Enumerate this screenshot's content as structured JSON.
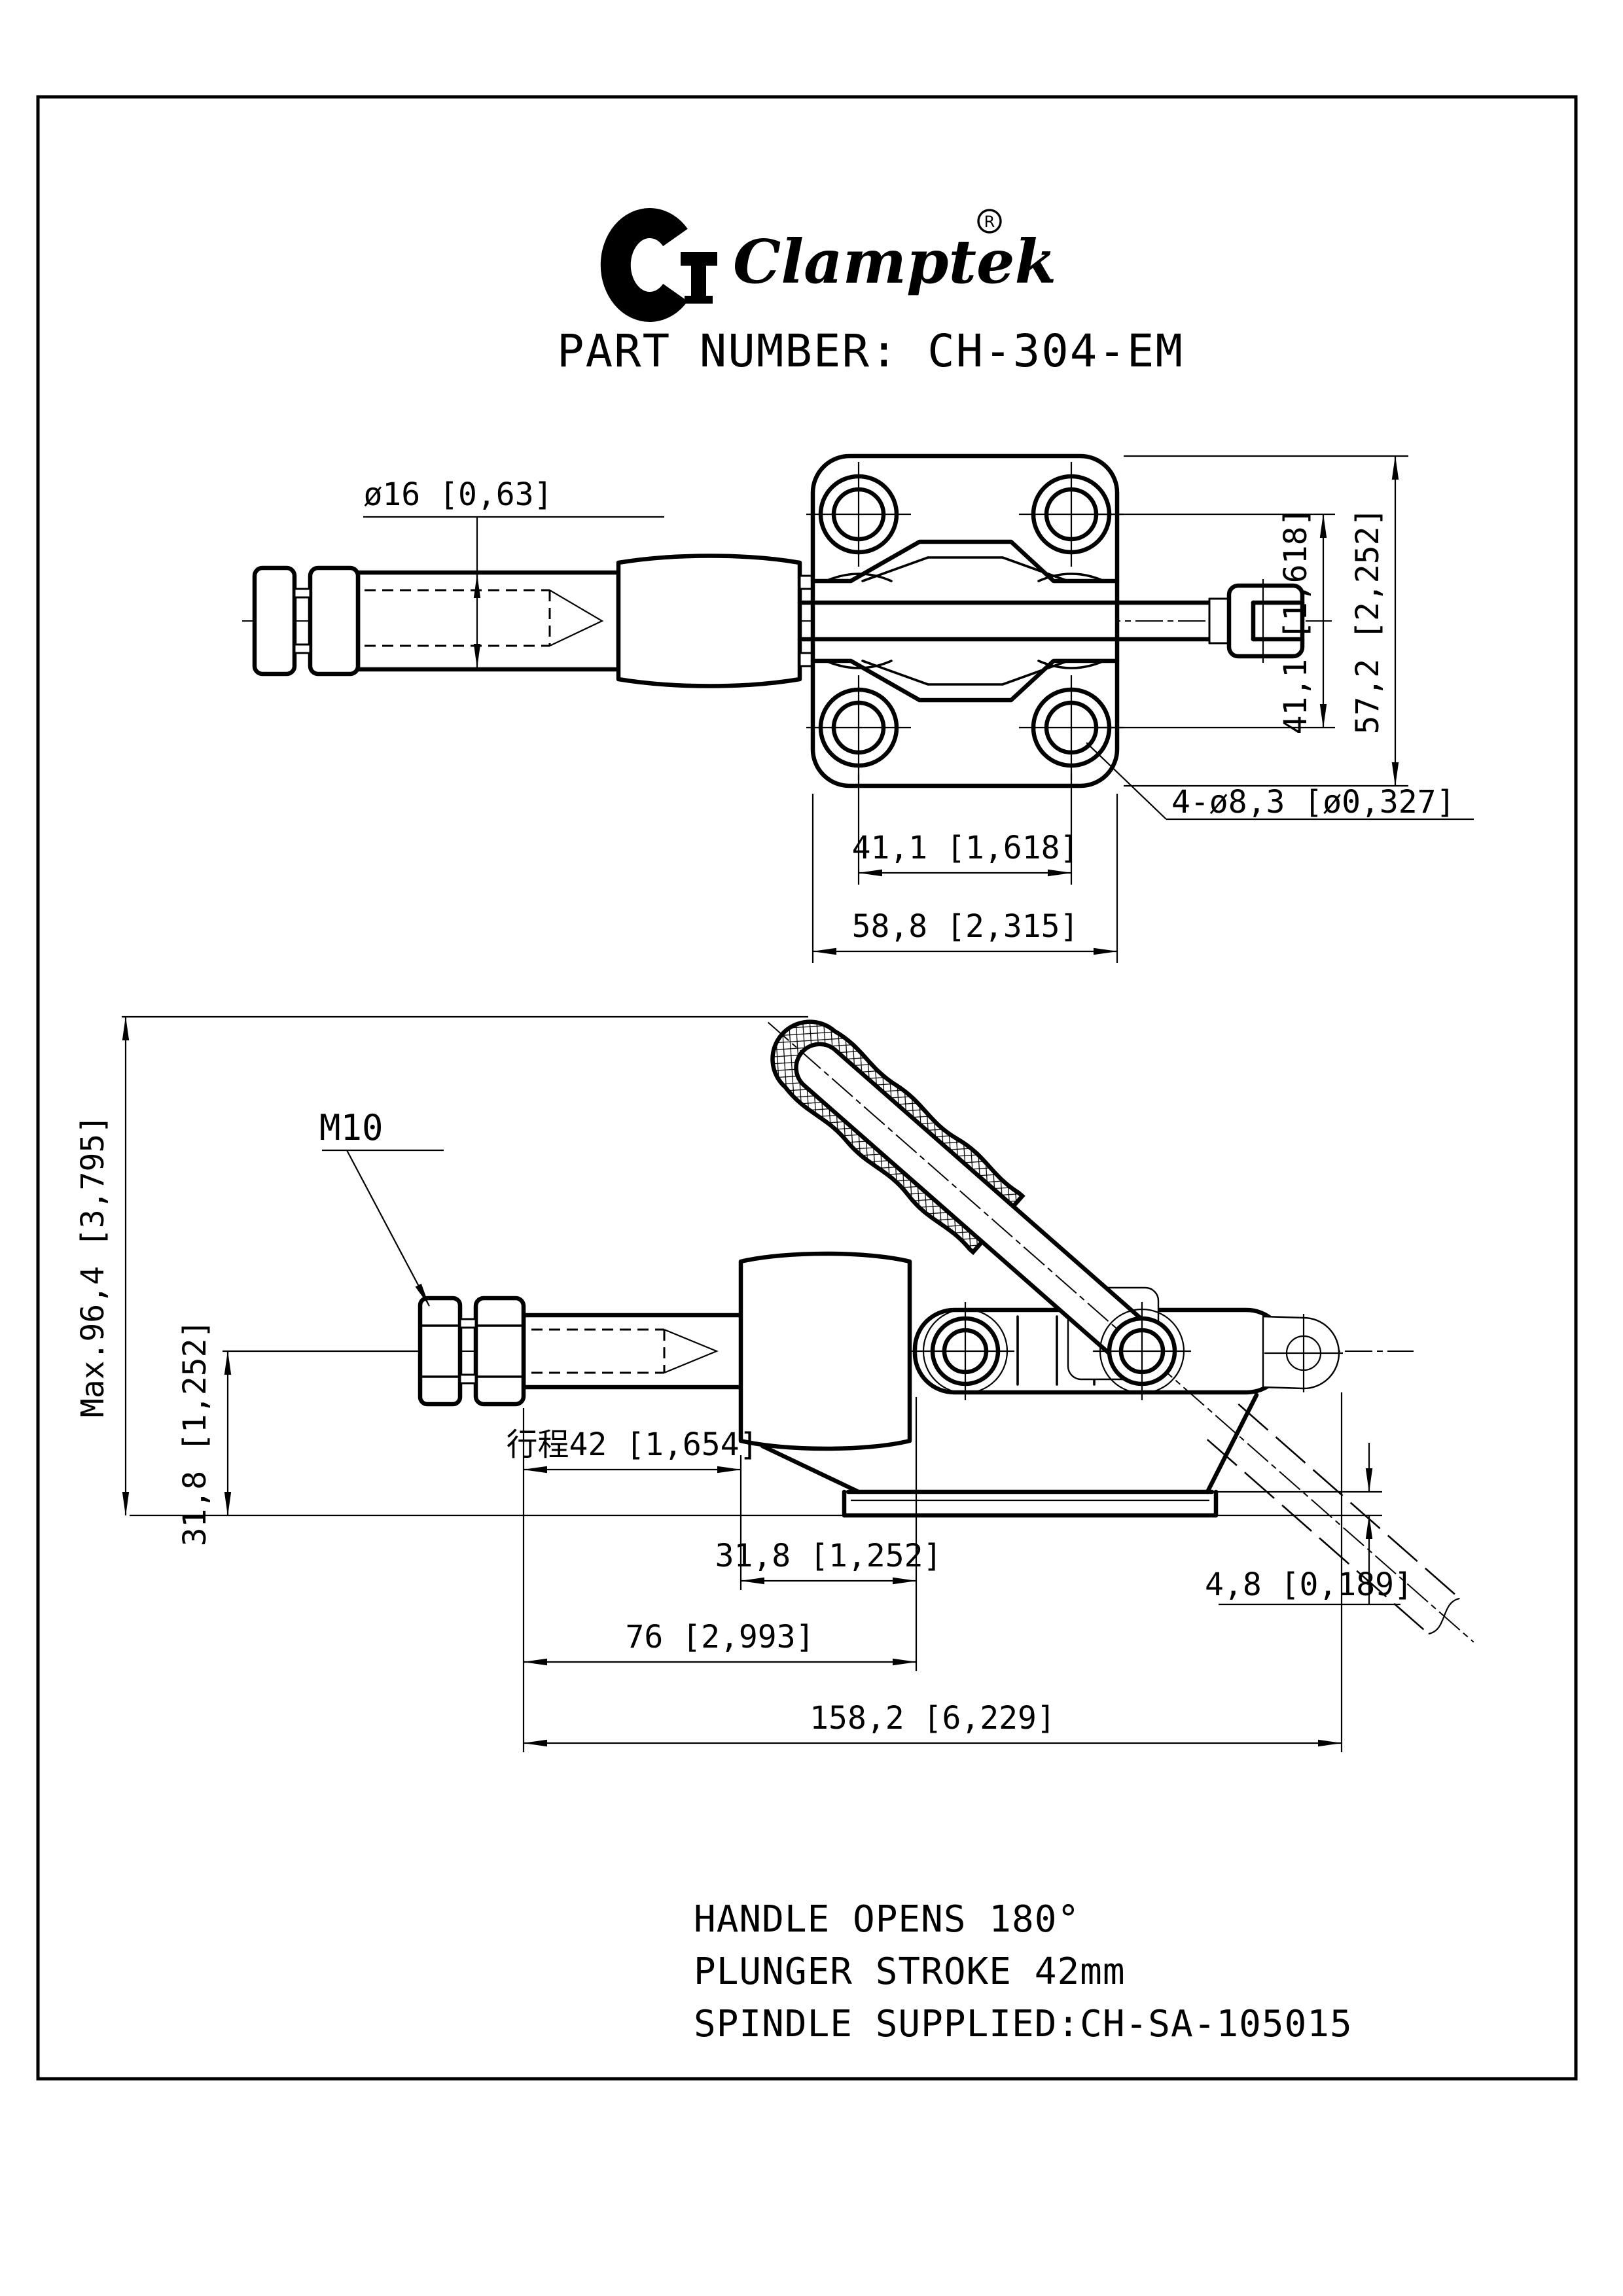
{
  "colors": {
    "ink": "#000000",
    "paper": "#ffffff"
  },
  "brand": {
    "monogram": "CT",
    "name": "Clamptek",
    "registered": "®"
  },
  "title": "PART NUMBER: CH-304-EM",
  "top_view": {
    "dim_spindle_diameter": "ø16 [0,63]",
    "dim_hole_pitch_vertical": "41,1 [1,618]",
    "dim_plate_height": "57,2 [2,252]",
    "dim_mounting_holes": "4-ø8,3 [ø0,327]",
    "dim_hole_pitch_horizontal": "41,1 [1,618]",
    "dim_plate_width": "58,8 [2,315]"
  },
  "side_view": {
    "label_thread": "M10",
    "dim_max_height": "Max.96,4 [3,795]",
    "dim_centerline_to_base": "31,8 [1,252]",
    "dim_plunger_stroke": "行程42 [1,654]",
    "dim_body_width": "31,8 [1,252]",
    "dim_nut_to_body": "76 [2,993]",
    "dim_overall_length": "158,2 [6,229]",
    "dim_flange_thickness": "4,8 [0,189]"
  },
  "notes": {
    "line1": "HANDLE OPENS 180°",
    "line2": "PLUNGER STROKE  42mm",
    "line3": "SPINDLE SUPPLIED:CH-SA-105015"
  }
}
